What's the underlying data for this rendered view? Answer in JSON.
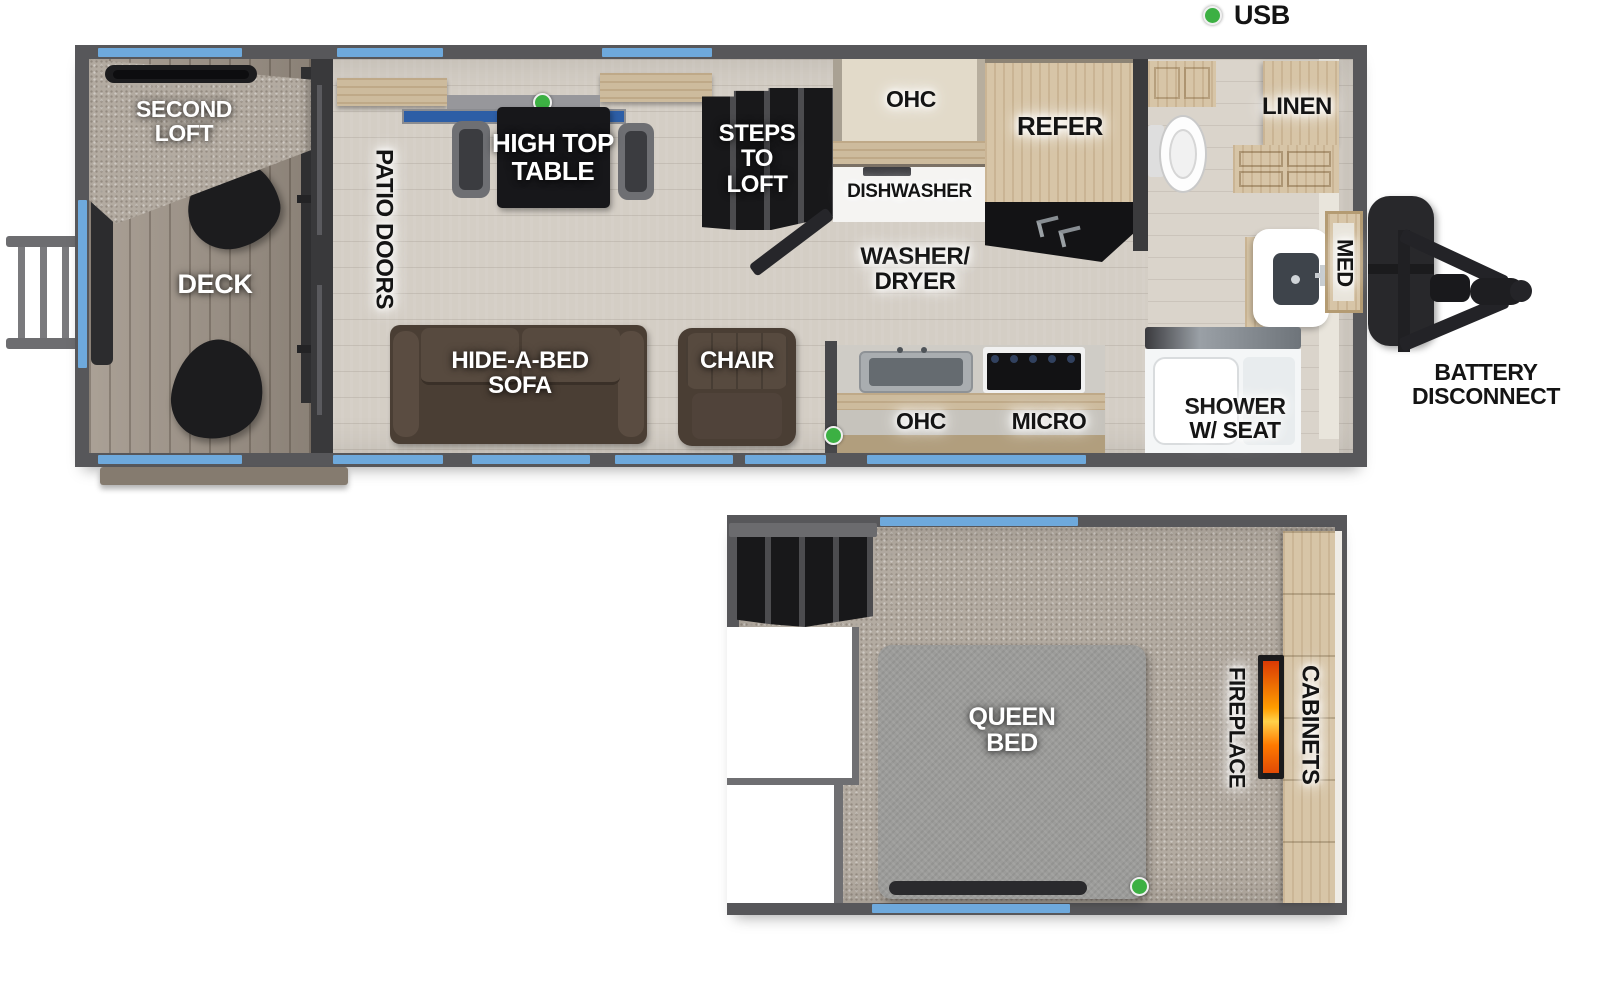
{
  "legend": {
    "usb": "USB"
  },
  "colors": {
    "wall": "#57575a",
    "window_blue": "#6ea9dc",
    "window_accent": "#2d5ea6",
    "usb_green": "#3cb043",
    "carpet": "#b3aba1",
    "wood_floor": "#d4cec5",
    "deck_wood": "#a1968a",
    "cabinet_wood": "#d7c5a7",
    "sofa_brown": "#4a3e34",
    "bed": "#9c9c9a",
    "flame": "#ff9d00"
  },
  "main_floor": {
    "second_loft": "SECOND\nLOFT",
    "deck": "DECK",
    "patio_doors": "PATIO DOORS",
    "high_top_table": "HIGH TOP\nTABLE",
    "steps_to_loft": "STEPS\nTO\nLOFT",
    "ohc_upper": "OHC",
    "dishwasher": "DISHWASHER",
    "washer_dryer": "WASHER/\nDRYER",
    "refer": "REFER",
    "linen": "LINEN",
    "med": "MED",
    "hide_a_bed_sofa": "HIDE-A-BED\nSOFA",
    "chair": "CHAIR",
    "ohc_lower": "OHC",
    "micro": "MICRO",
    "shower": "SHOWER\nW/ SEAT",
    "battery_disconnect": "BATTERY\nDISCONNECT"
  },
  "loft": {
    "queen_bed": "QUEEN\nBED",
    "fireplace": "FIREPLACE",
    "cabinets": "CABINETS"
  }
}
